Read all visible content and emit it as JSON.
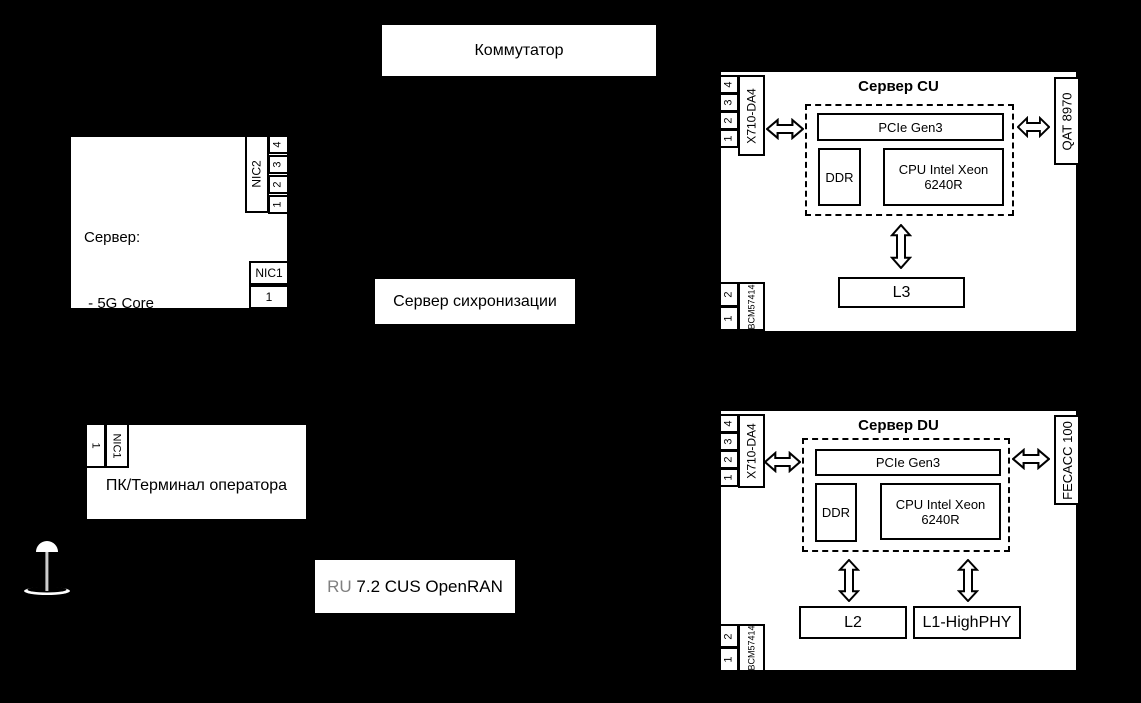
{
  "colors": {
    "background": "#000000",
    "box_fill": "#ffffff",
    "line": "#000000",
    "ru_prefix_gray": "#808080"
  },
  "switch": {
    "label": "Коммутатор"
  },
  "sync_server": {
    "label": "Сервер сихронизации"
  },
  "core_server": {
    "lines": [
      "Сервер:",
      " - 5G Core",
      " - Генератор трафика"
    ],
    "nic2": {
      "label": "NIC2",
      "ports": [
        "4",
        "3",
        "2",
        "1"
      ]
    },
    "nic1": {
      "label": "NIC1",
      "ports": [
        "1"
      ]
    }
  },
  "cu_server": {
    "title": "Сервер CU",
    "nic_left": {
      "label": "X710-DA4",
      "ports": [
        "4",
        "3",
        "2",
        "1"
      ]
    },
    "nic_bottom": {
      "label": "BCM57414",
      "ports": [
        "2",
        "1"
      ]
    },
    "accel": {
      "label": "QAT 8970"
    },
    "pcie": {
      "label": "PCIe Gen3"
    },
    "ddr": {
      "label": "DDR"
    },
    "cpu": {
      "lines": [
        "CPU Intel Xeon",
        "6240R"
      ]
    },
    "l3": {
      "label": "L3"
    }
  },
  "du_server": {
    "title": "Сервер DU",
    "nic_left": {
      "label": "X710-DA4",
      "ports": [
        "4",
        "3",
        "2",
        "1"
      ]
    },
    "nic_bottom": {
      "label": "BCM57414",
      "ports": [
        "2",
        "1"
      ]
    },
    "accel": {
      "label": "FECACC 100"
    },
    "pcie": {
      "label": "PCIe Gen3"
    },
    "ddr": {
      "label": "DDR"
    },
    "cpu": {
      "lines": [
        "CPU Intel Xeon",
        "6240R"
      ]
    },
    "l2": {
      "label": "L2"
    },
    "l1": {
      "label": "L1-HighPHY"
    }
  },
  "operator_pc": {
    "label": "ПК/Терминал оператора",
    "nic1": {
      "label": "NIC1",
      "ports": [
        "1"
      ]
    }
  },
  "ru_node": {
    "prefix": "RU",
    "rest": " 7.2 CUS OpenRAN"
  },
  "icons": {
    "antenna": "antenna-icon"
  }
}
